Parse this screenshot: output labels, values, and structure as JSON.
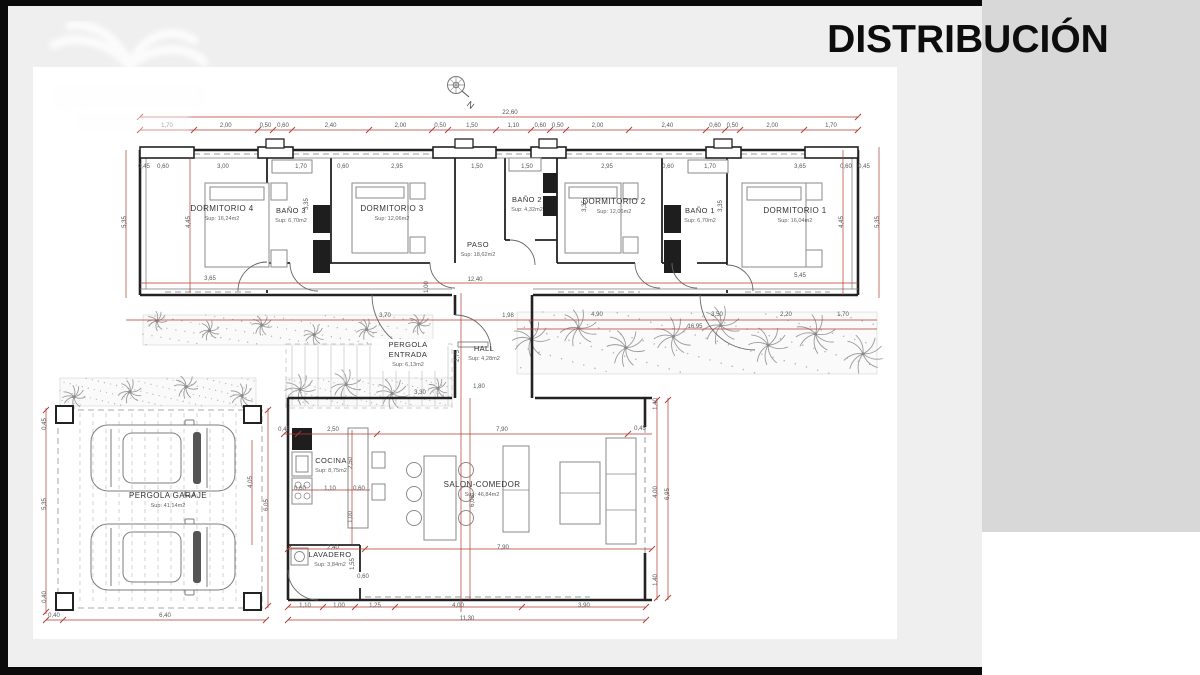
{
  "slide": {
    "title": "DISTRIBUCIÓN"
  },
  "compass": {
    "label": "N"
  },
  "colors": {
    "frame_black": "#0a0a0a",
    "slide_gray": "#efefef",
    "panel_gray": "#d8d8d8",
    "sheet_white": "#ffffff",
    "dimension_red": "#b03a30",
    "wall_black": "#222222",
    "vegetation_gray": "#9b9b9b"
  },
  "plan": {
    "rooms": [
      {
        "id": "dormitorio-4",
        "name": "DORMITORIO 4",
        "area": "Sup: 16,24m2",
        "x": 222,
        "y": 211
      },
      {
        "id": "bano-3",
        "name": "BAÑO 3",
        "area": "Sup: 6,70m2",
        "x": 291,
        "y": 213
      },
      {
        "id": "dormitorio-3",
        "name": "DORMITORIO 3",
        "area": "Sup: 12,06m2",
        "x": 392,
        "y": 211
      },
      {
        "id": "bano-2",
        "name": "BAÑO 2",
        "area": "Sup: 4,32m2",
        "x": 527,
        "y": 202
      },
      {
        "id": "dormitorio-2",
        "name": "DORMITORIO 2",
        "area": "Sup: 12,06m2",
        "x": 614,
        "y": 204
      },
      {
        "id": "bano-1",
        "name": "BAÑO 1",
        "area": "Sup: 6,70m2",
        "x": 700,
        "y": 213
      },
      {
        "id": "dormitorio-1",
        "name": "DORMITORIO 1",
        "area": "Sup: 16,04m2",
        "x": 795,
        "y": 213
      },
      {
        "id": "paso",
        "name": "PASO",
        "area": "Sup: 18,62m2",
        "x": 478,
        "y": 247
      },
      {
        "id": "pergola-entrada",
        "name": "PERGOLA ENTRADA",
        "area": "Sup: 6,13m2",
        "x": 408,
        "y": 347,
        "two_lines": true
      },
      {
        "id": "hall",
        "name": "HALL",
        "area": "Sup: 4,28m2",
        "x": 484,
        "y": 351
      },
      {
        "id": "cocina",
        "name": "COCINA",
        "area": "Sup: 8,75m2",
        "x": 331,
        "y": 463
      },
      {
        "id": "salon-comedor",
        "name": "SALON-COMEDOR",
        "area": "Sup: 46,84m2",
        "x": 482,
        "y": 487
      },
      {
        "id": "lavadero",
        "name": "LAVADERO",
        "area": "Sup: 3,84m2",
        "x": 330,
        "y": 557
      },
      {
        "id": "pergola-garaje",
        "name": "PERGOLA GARAJE",
        "area": "Sup: 41,14m2",
        "x": 168,
        "y": 498
      }
    ],
    "dim_total_top": "22,60",
    "dim_chain_top": [
      "1,70",
      "2,00",
      "0,50",
      "0,60",
      "2,40",
      "2,00",
      "0,50",
      "1,50",
      "1,10",
      "0,60",
      "0,50",
      "2,00",
      "2,40",
      "0,60",
      "0,50",
      "2,00",
      "1,70"
    ],
    "dim_row2": [
      "0,45",
      "0,60",
      "3,00",
      "1,70",
      "0,60",
      "2,95",
      "1,50",
      "1,50",
      "2,95",
      "0,60",
      "1,70",
      "3,65",
      "0,60",
      "0,45"
    ],
    "dim_labels": [
      {
        "t": "5,35",
        "x": 126,
        "y": 222,
        "v": 1
      },
      {
        "t": "4,45",
        "x": 190,
        "y": 222,
        "v": 1
      },
      {
        "t": "3,35",
        "x": 308,
        "y": 204,
        "v": 1
      },
      {
        "t": "3,35",
        "x": 586,
        "y": 206,
        "v": 1
      },
      {
        "t": "3,35",
        "x": 722,
        "y": 206,
        "v": 1
      },
      {
        "t": "4,45",
        "x": 843,
        "y": 222,
        "v": 1
      },
      {
        "t": "5,35",
        "x": 879,
        "y": 222,
        "v": 1
      },
      {
        "t": "3,65",
        "x": 210,
        "y": 280
      },
      {
        "t": "12,40",
        "x": 475,
        "y": 281
      },
      {
        "t": "1,00",
        "x": 428,
        "y": 287,
        "v": 1
      },
      {
        "t": "5,45",
        "x": 800,
        "y": 277
      },
      {
        "t": "3,70",
        "x": 385,
        "y": 317
      },
      {
        "t": "1,98",
        "x": 508,
        "y": 317
      },
      {
        "t": "4,90",
        "x": 597,
        "y": 316
      },
      {
        "t": "3,50",
        "x": 717,
        "y": 316
      },
      {
        "t": "2,20",
        "x": 786,
        "y": 316
      },
      {
        "t": "1,70",
        "x": 843,
        "y": 316
      },
      {
        "t": "16,95",
        "x": 695,
        "y": 328
      },
      {
        "t": "2,75",
        "x": 459,
        "y": 356,
        "v": 1
      },
      {
        "t": "1,80",
        "x": 479,
        "y": 388
      },
      {
        "t": "3,30",
        "x": 420,
        "y": 394
      },
      {
        "t": "0,45",
        "x": 284,
        "y": 431
      },
      {
        "t": "2,50",
        "x": 333,
        "y": 431
      },
      {
        "t": "7,90",
        "x": 502,
        "y": 431
      },
      {
        "t": "0,60",
        "x": 300,
        "y": 490
      },
      {
        "t": "1,10",
        "x": 330,
        "y": 490
      },
      {
        "t": "0,60",
        "x": 359,
        "y": 490
      },
      {
        "t": "2,50",
        "x": 352,
        "y": 463,
        "v": 1
      },
      {
        "t": "1,00",
        "x": 352,
        "y": 517,
        "v": 1
      },
      {
        "t": "6,05",
        "x": 474,
        "y": 501,
        "v": 1
      },
      {
        "t": "2,40",
        "x": 333,
        "y": 549
      },
      {
        "t": "7,90",
        "x": 503,
        "y": 549
      },
      {
        "t": "1,55",
        "x": 354,
        "y": 564,
        "v": 1
      },
      {
        "t": "0,60",
        "x": 363,
        "y": 578
      },
      {
        "t": "1,40",
        "x": 657,
        "y": 404,
        "v": 1
      },
      {
        "t": "0,45",
        "x": 640,
        "y": 430
      },
      {
        "t": "4,00",
        "x": 657,
        "y": 492,
        "v": 1
      },
      {
        "t": "6,95",
        "x": 669,
        "y": 494,
        "v": 1
      },
      {
        "t": "1,40",
        "x": 657,
        "y": 580,
        "v": 1
      },
      {
        "t": "1,10",
        "x": 305,
        "y": 607
      },
      {
        "t": "1,00",
        "x": 339,
        "y": 607
      },
      {
        "t": "1,25",
        "x": 375,
        "y": 607
      },
      {
        "t": "4,00",
        "x": 458,
        "y": 607
      },
      {
        "t": "3,90",
        "x": 584,
        "y": 607
      },
      {
        "t": "11,30",
        "x": 467,
        "y": 620
      },
      {
        "t": "0,45",
        "x": 46,
        "y": 424,
        "v": 1
      },
      {
        "t": "5,35",
        "x": 46,
        "y": 504,
        "v": 1
      },
      {
        "t": "0,40",
        "x": 46,
        "y": 597,
        "v": 1
      },
      {
        "t": "0,40",
        "x": 54,
        "y": 617
      },
      {
        "t": "6,40",
        "x": 165,
        "y": 617
      },
      {
        "t": "4,05",
        "x": 252,
        "y": 482,
        "v": 1
      },
      {
        "t": "6,05",
        "x": 268,
        "y": 505,
        "v": 1
      }
    ]
  }
}
